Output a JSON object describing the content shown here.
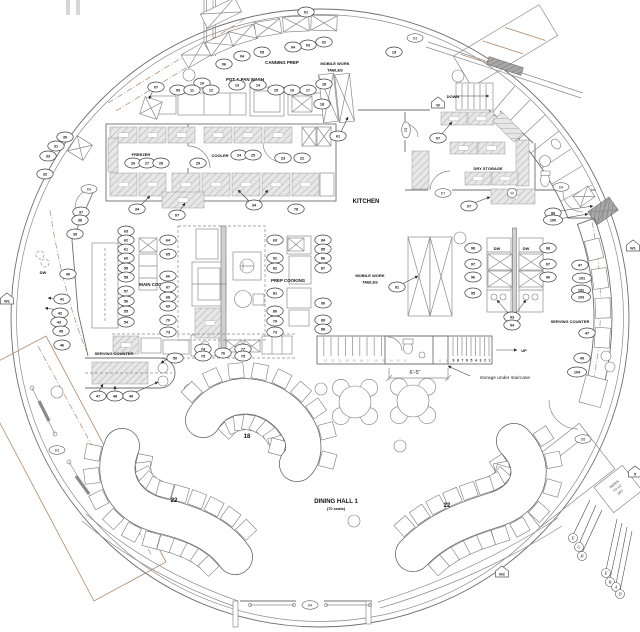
{
  "labels": {
    "canning_prep": "CANNING PREP",
    "pot_pan_wash": "POT & PAN WASH",
    "mobile_work_1a": "MOBILE WORK",
    "mobile_work_1b": "TABLES",
    "freezer": "FREEZER",
    "cooler": "COOLER",
    "kitchen": "KITCHEN",
    "dry_storage": "DRY STORAGE",
    "mobile_work_2a": "MOBILE WORK",
    "mobile_work_2b": "TABLES",
    "main_cooking": "MAIN COOKING",
    "prep_cooking": "PREP COOKING",
    "serving_counter_left": "SERVING COUNTER",
    "serving_counter_right": "SERVING COUNTER",
    "dw_left": "DW",
    "dw_right": "DW",
    "dw_serving": "DW"
  },
  "stairs": {
    "down_label": "DOWN",
    "up_label": "UP",
    "dimension": "6'-5\"",
    "storage_note": "storage under staircase",
    "treads_light": [
      "23",
      "22",
      "21",
      "20",
      "19",
      "18",
      "17",
      "16",
      "15"
    ],
    "treads_mid": [
      "14",
      "13",
      "12"
    ],
    "treads_small": [
      "11",
      "10"
    ],
    "treads_bold": [
      "9",
      "8",
      "7",
      "6",
      "5",
      "4",
      "3",
      "2",
      "1"
    ]
  },
  "dining": {
    "hall_label": "DINING HALL 1",
    "seats_label": "(70 seats)",
    "banquet_tables": [
      {
        "label": "18",
        "seats": 18
      },
      {
        "label": "22",
        "seats": 22
      },
      {
        "label": "22",
        "seats": 22
      }
    ],
    "round_table_seats": 4
  },
  "note_box": {
    "lines": [
      "REFER",
      "TO 1/2",
      "DET"
    ]
  },
  "callouts": [
    {
      "t": "01",
      "x": 306,
      "y": 12
    },
    {
      "t": "02",
      "x": 324,
      "y": 42
    },
    {
      "t": "03",
      "x": 308,
      "y": 45
    },
    {
      "t": "04",
      "x": 293,
      "y": 47
    },
    {
      "t": "04",
      "x": 242,
      "y": 56
    },
    {
      "t": "05",
      "x": 262,
      "y": 52
    },
    {
      "t": "06",
      "x": 224,
      "y": 64
    },
    {
      "t": "07",
      "x": 156,
      "y": 87
    },
    {
      "t": "09",
      "x": 178,
      "y": 90
    },
    {
      "t": "10",
      "x": 202,
      "y": 83
    },
    {
      "t": "11",
      "x": 192,
      "y": 90
    },
    {
      "t": "12",
      "x": 211,
      "y": 90
    },
    {
      "t": "13",
      "x": 237,
      "y": 85
    },
    {
      "t": "14",
      "x": 258,
      "y": 85
    },
    {
      "t": "15",
      "x": 276,
      "y": 90
    },
    {
      "t": "16",
      "x": 292,
      "y": 90
    },
    {
      "t": "17",
      "x": 308,
      "y": 90
    },
    {
      "t": "18",
      "x": 322,
      "y": 104
    },
    {
      "t": "18",
      "x": 324,
      "y": 84
    },
    {
      "t": "19",
      "x": 394,
      "y": 52
    },
    {
      "t": "61",
      "x": 338,
      "y": 136
    },
    {
      "t": "30",
      "x": 65,
      "y": 137
    },
    {
      "t": "31",
      "x": 56,
      "y": 146
    },
    {
      "t": "33",
      "x": 48,
      "y": 156
    },
    {
      "t": "32",
      "x": 45,
      "y": 174
    },
    {
      "t": "37",
      "x": 81,
      "y": 212
    },
    {
      "t": "38",
      "x": 80,
      "y": 220
    },
    {
      "t": "39",
      "x": 75,
      "y": 234
    },
    {
      "t": "40",
      "x": 68,
      "y": 274
    },
    {
      "t": "41",
      "x": 62,
      "y": 299
    },
    {
      "t": "42",
      "x": 60,
      "y": 313
    },
    {
      "t": "43",
      "x": 59,
      "y": 322
    },
    {
      "t": "45",
      "x": 61,
      "y": 331
    },
    {
      "t": "46",
      "x": 62,
      "y": 345
    },
    {
      "t": "26",
      "x": 133,
      "y": 163
    },
    {
      "t": "27",
      "x": 147,
      "y": 163
    },
    {
      "t": "28",
      "x": 161,
      "y": 163
    },
    {
      "t": "29",
      "x": 198,
      "y": 163
    },
    {
      "t": "24",
      "x": 239,
      "y": 155
    },
    {
      "t": "25",
      "x": 253,
      "y": 155
    },
    {
      "t": "23",
      "x": 283,
      "y": 158
    },
    {
      "t": "22",
      "x": 302,
      "y": 158
    },
    {
      "t": "34",
      "x": 137,
      "y": 209
    },
    {
      "t": "07",
      "x": 177,
      "y": 215
    },
    {
      "t": "34",
      "x": 254,
      "y": 205
    },
    {
      "t": "78",
      "x": 296,
      "y": 209
    },
    {
      "t": "63",
      "x": 126,
      "y": 231
    },
    {
      "t": "62",
      "x": 126,
      "y": 240
    },
    {
      "t": "61",
      "x": 126,
      "y": 249
    },
    {
      "t": "60",
      "x": 126,
      "y": 258
    },
    {
      "t": "59",
      "x": 126,
      "y": 268
    },
    {
      "t": "58",
      "x": 126,
      "y": 277
    },
    {
      "t": "57",
      "x": 126,
      "y": 291
    },
    {
      "t": "56",
      "x": 126,
      "y": 301
    },
    {
      "t": "55",
      "x": 126,
      "y": 311
    },
    {
      "t": "54",
      "x": 126,
      "y": 322
    },
    {
      "t": "64",
      "x": 168,
      "y": 240
    },
    {
      "t": "65",
      "x": 168,
      "y": 254
    },
    {
      "t": "66",
      "x": 168,
      "y": 276
    },
    {
      "t": "67",
      "x": 168,
      "y": 287
    },
    {
      "t": "68",
      "x": 168,
      "y": 297
    },
    {
      "t": "69",
      "x": 168,
      "y": 306
    },
    {
      "t": "70",
      "x": 168,
      "y": 320
    },
    {
      "t": "73",
      "x": 168,
      "y": 332
    },
    {
      "t": "63",
      "x": 275,
      "y": 240
    },
    {
      "t": "92",
      "x": 275,
      "y": 258
    },
    {
      "t": "82",
      "x": 275,
      "y": 268
    },
    {
      "t": "81",
      "x": 275,
      "y": 293
    },
    {
      "t": "80",
      "x": 275,
      "y": 311
    },
    {
      "t": "79",
      "x": 275,
      "y": 321
    },
    {
      "t": "73",
      "x": 275,
      "y": 332
    },
    {
      "t": "84",
      "x": 323,
      "y": 240
    },
    {
      "t": "85",
      "x": 323,
      "y": 249
    },
    {
      "t": "86",
      "x": 323,
      "y": 258
    },
    {
      "t": "87",
      "x": 323,
      "y": 268
    },
    {
      "t": "90",
      "x": 323,
      "y": 303
    },
    {
      "t": "89",
      "x": 323,
      "y": 320
    },
    {
      "t": "88",
      "x": 323,
      "y": 329
    },
    {
      "t": "74",
      "x": 203,
      "y": 349
    },
    {
      "t": "75",
      "x": 203,
      "y": 356
    },
    {
      "t": "76",
      "x": 223,
      "y": 353
    },
    {
      "t": "77",
      "x": 243,
      "y": 349
    },
    {
      "t": "75",
      "x": 243,
      "y": 356
    },
    {
      "t": "50",
      "x": 175,
      "y": 358
    },
    {
      "t": "47",
      "x": 98,
      "y": 396
    },
    {
      "t": "48",
      "x": 115,
      "y": 396
    },
    {
      "t": "49",
      "x": 131,
      "y": 396
    },
    {
      "t": "98",
      "x": 473,
      "y": 248
    },
    {
      "t": "97",
      "x": 473,
      "y": 264
    },
    {
      "t": "96",
      "x": 473,
      "y": 277
    },
    {
      "t": "95",
      "x": 473,
      "y": 293
    },
    {
      "t": "98",
      "x": 548,
      "y": 248
    },
    {
      "t": "97",
      "x": 548,
      "y": 264
    },
    {
      "t": "96",
      "x": 548,
      "y": 277
    },
    {
      "t": "93",
      "x": 512,
      "y": 317
    },
    {
      "t": "94",
      "x": 512,
      "y": 325
    },
    {
      "t": "91",
      "x": 397,
      "y": 287
    },
    {
      "t": "07",
      "x": 438,
      "y": 138
    },
    {
      "t": "07",
      "x": 469,
      "y": 206
    },
    {
      "t": "99",
      "x": 553,
      "y": 213
    },
    {
      "t": "100",
      "x": 553,
      "y": 220
    },
    {
      "t": "47",
      "x": 580,
      "y": 265
    },
    {
      "t": "101",
      "x": 582,
      "y": 278
    },
    {
      "t": "102",
      "x": 581,
      "y": 290
    },
    {
      "t": "103",
      "x": 581,
      "y": 297
    },
    {
      "t": "47",
      "x": 587,
      "y": 333
    },
    {
      "t": "49",
      "x": 582,
      "y": 358
    },
    {
      "t": "104",
      "x": 577,
      "y": 372
    }
  ],
  "door_tags": [
    {
      "t": "D3",
      "x": 415,
      "y": 38
    },
    {
      "t": "D2",
      "x": 406,
      "y": 130,
      "r": 90
    },
    {
      "t": "D9",
      "x": 89,
      "y": 189
    },
    {
      "t": "D7",
      "x": 443,
      "y": 193
    },
    {
      "t": "D9",
      "x": 561,
      "y": 187
    },
    {
      "t": "D5",
      "x": 583,
      "y": 439
    },
    {
      "t": "D3",
      "x": 57,
      "y": 450
    },
    {
      "t": "D4",
      "x": 310,
      "y": 605
    }
  ],
  "marker_tags": [
    {
      "t": "W",
      "x": 438,
      "y": 104
    },
    {
      "t": "W1",
      "x": 7,
      "y": 300
    },
    {
      "t": "W1",
      "x": 633,
      "y": 247
    },
    {
      "t": "W2",
      "x": 502,
      "y": 573
    },
    {
      "t": "5",
      "x": 635,
      "y": 473
    }
  ],
  "circle_tags": [
    {
      "t": "W",
      "x": 512,
      "y": 193
    }
  ],
  "letter_tags": [
    {
      "t": "E",
      "x": 573,
      "y": 538
    },
    {
      "t": "G",
      "x": 579,
      "y": 547
    },
    {
      "t": "H",
      "x": 582,
      "y": 556
    },
    {
      "t": "E",
      "x": 606,
      "y": 573
    },
    {
      "t": "B",
      "x": 610,
      "y": 582
    },
    {
      "t": "A",
      "x": 616,
      "y": 587
    },
    {
      "t": "D",
      "x": 620,
      "y": 594
    }
  ]
}
